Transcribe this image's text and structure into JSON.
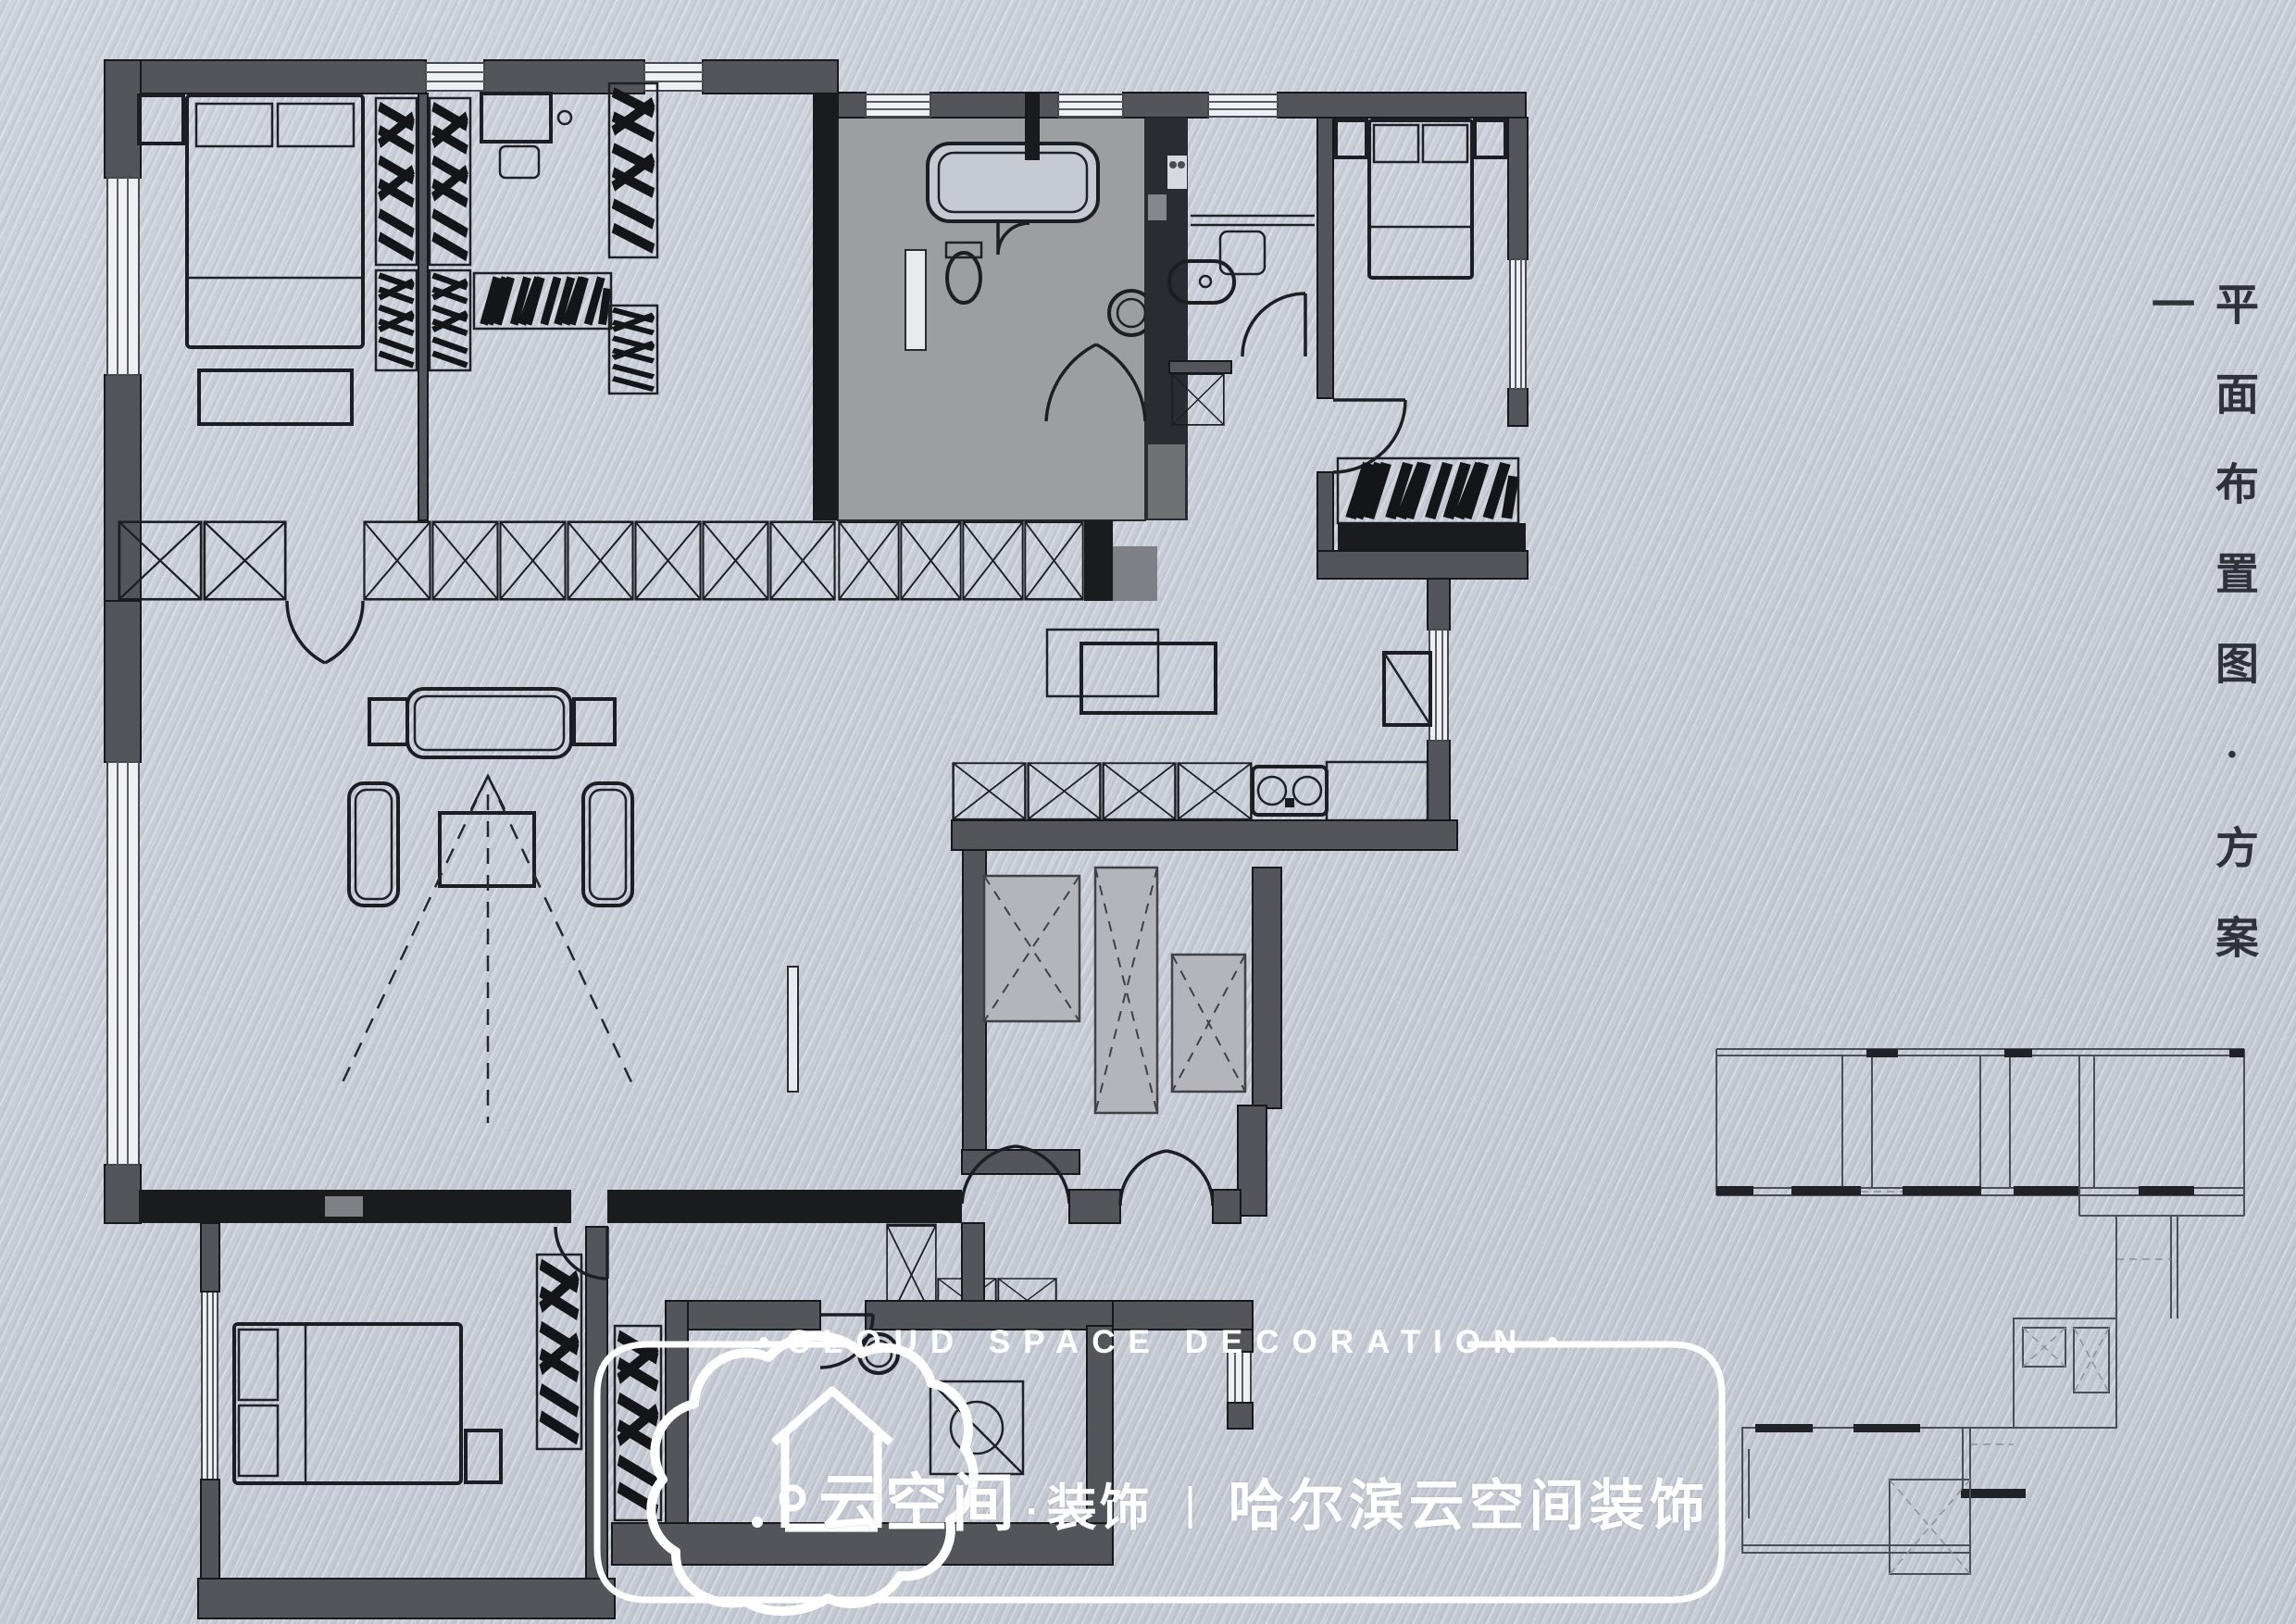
{
  "page": {
    "background_color": "#c9ced8"
  },
  "side_title": {
    "text": "平面布置图·方案一"
  },
  "watermark": {
    "bullet": "●",
    "top_label": "CLOUD SPACE DECORATION",
    "brand_name": "云空间",
    "brand_divider": "·",
    "brand_suffix": "装饰",
    "separator": "丨",
    "company_name": "哈尔滨云空间装饰",
    "color": "#ffffff"
  },
  "floorplan": {
    "colors": {
      "wall_gray": "#53555b",
      "wall_black": "#1a1b1f",
      "bath_floor": "#9d9ea2",
      "elevator_shaft": "#b3b5ba",
      "window_fill": "#eef0f4",
      "furniture_line": "#1d1e23"
    }
  }
}
